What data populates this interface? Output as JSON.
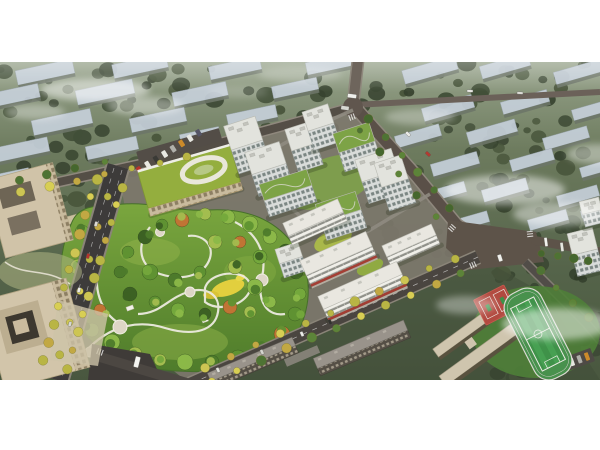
{
  "image": {
    "kind": "aerial architectural rendering",
    "description": "Bird's-eye master-plan rendering of a residential compound: white high-rise towers and mid-rise slabs around a large landscaped central park, a green-roofed kindergarten, tree-lined boulevards, a beige office campus at left, a school with red courts and a green pitch at lower right, and hazy rows of existing apartment blocks in the background.",
    "letterbox_color": "#ffffff",
    "visible_text": []
  },
  "palette": {
    "background_green_top": "#97a38b",
    "background_green_mid": "#5f6e52",
    "background_green_deep": "#49573f",
    "background_block_roof": "#c6d0da",
    "mist": "#ffffff",
    "asphalt_dark": "#474341",
    "estate_road": "#564c44",
    "curb_light": "#8f887d",
    "tower_facade": "#e3e5e1",
    "tower_roof": "#e2e3dd",
    "green_roof": "#7da346",
    "slab_band_light": "#f0efe9",
    "awning_red": "#a83d34",
    "kindergarten_roof": "#94ae3e",
    "kindergarten_facade": "#dcc794",
    "office_beige": "#d0c3a8",
    "park_lawn": "#7aa63e",
    "park_path": "#eceadf",
    "meadow_yellow": "#e2cf3e",
    "street_tree_yellow": "#cdc553",
    "park_tree_green": "#4d7a2b",
    "autumn_tree_orange": "#c07434",
    "sports_field_green": "#3f9249",
    "court_red": "#b24a40",
    "school_roof_beige": "#cfc5ae",
    "existing_roof_grey": "#99938b"
  },
  "elements": {
    "background_district": "hazy rows of mid-rise apartment blocks among dark trees",
    "residential_towers": {
      "count": 12,
      "style": "white gridded facades, some planted green roofs"
    },
    "commercial_slabs": {
      "count": 4,
      "style": "white mid-rise slabs with red shop awnings"
    },
    "kindergarten": "green roof with white oval play loop, cream facade, car park",
    "central_park": "winding white paths, lawns, yellow meadow, dense mixed trees, small pavilions",
    "office_campus": "two beige office blocks with recessed courtyards and gardens",
    "school_campus": "beige classroom bars, red basketball courts, green pitch with white track",
    "existing_slabs": "two grey apartment slabs along the south street",
    "roads": "tree-lined boulevard, perimeter roads, large east intersection",
    "vehicles": "buses, vans and cars on the roads",
    "mist": "white haze drifting over the blocks"
  }
}
